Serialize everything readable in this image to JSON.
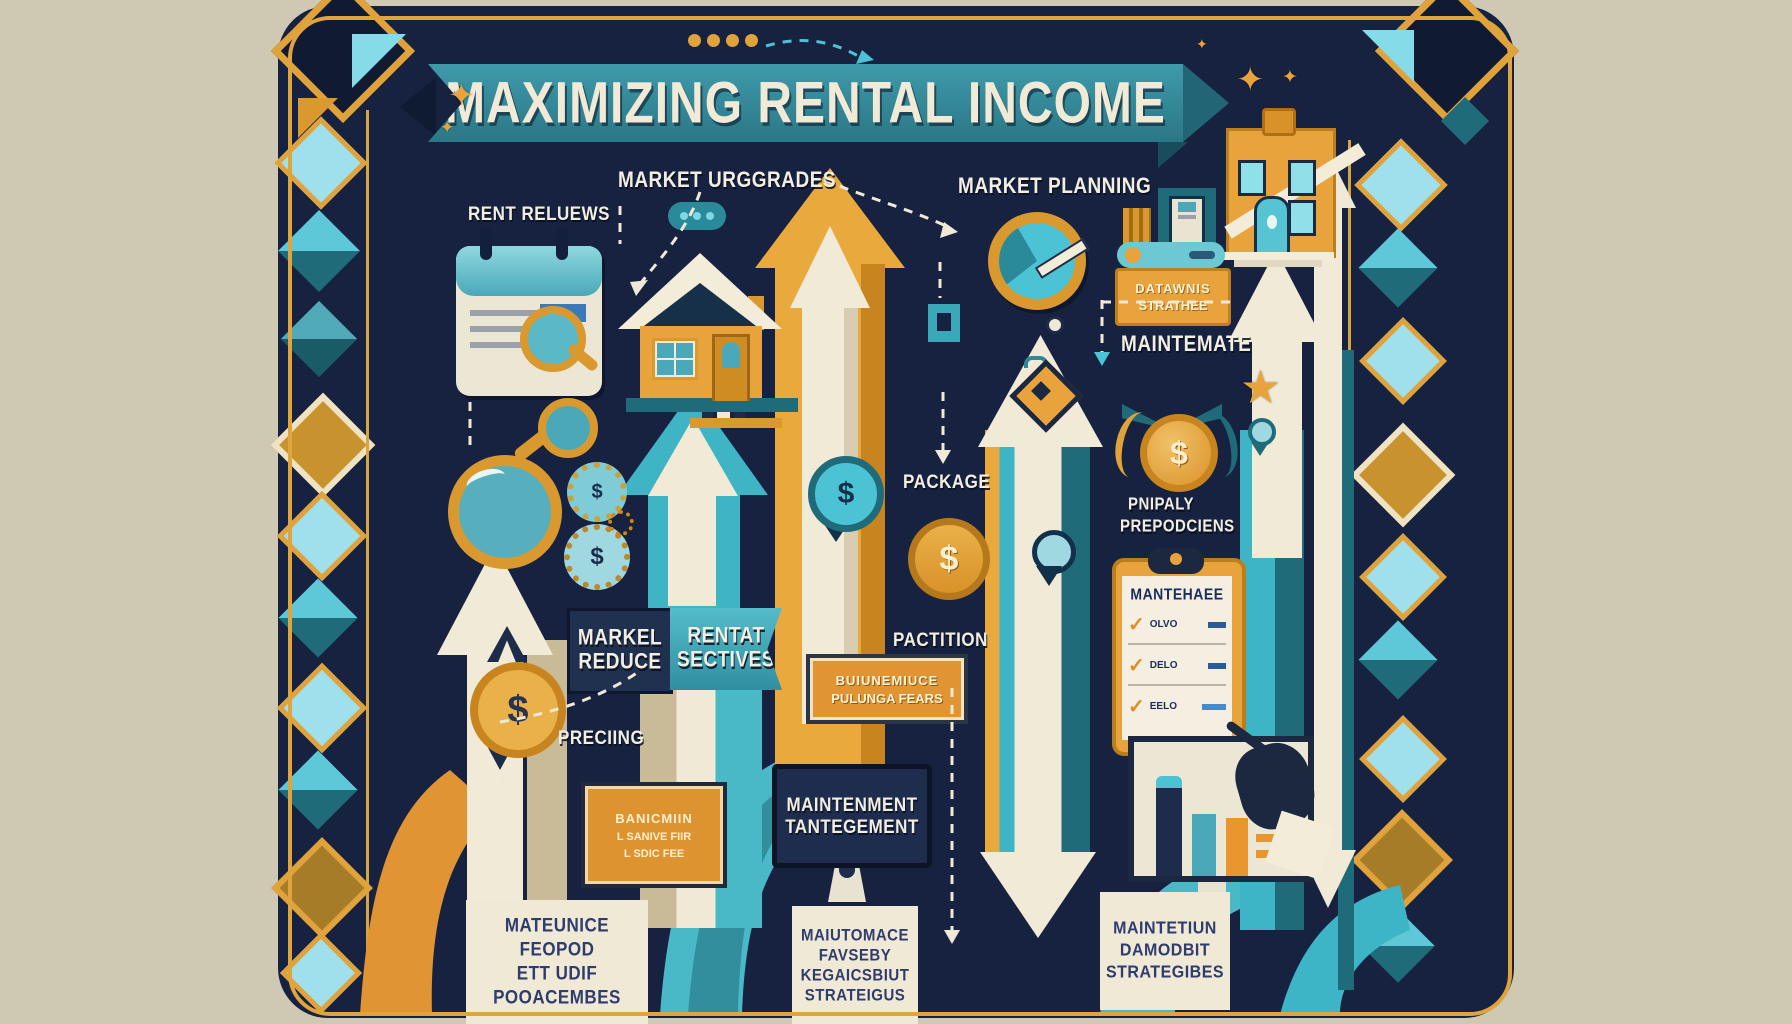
{
  "palette": {
    "background": "#cfc8b2",
    "panel_navy": "#172140",
    "teal": "#2f8fa0",
    "cyan": "#4cc3d4",
    "gold": "#e8a33d",
    "cream": "#f0ead6",
    "navy_box": "#1c2c4a"
  },
  "glyphs": {
    "sparkle": "✦",
    "star": "★",
    "dollar": "$",
    "check": "✓"
  },
  "title": {
    "banner": "MAXIMIZING RENTAL INCOME"
  },
  "labels": {
    "rent_reviews": "RENT RELUEWS",
    "market_upgrades": "MARKET URGGRADES",
    "market_planning": "MARKET PLANNING",
    "maintenate": "MAINTEMATE",
    "package": "PACKAGE",
    "pactition": "PACTITION",
    "pricing": "PRECIING",
    "properly_1": "PNIPALY",
    "properly_2": "PREPODCIENS"
  },
  "boxes": {
    "market_reduce": {
      "line1": "MARKEL",
      "line2": "REDUCE"
    },
    "rental_sectives": {
      "line1": "RENTAT",
      "line2": "SECTIVES"
    },
    "strategies_badge": {
      "line1": "DATAWNIS",
      "line2": "STRATHEE"
    },
    "package_fees": {
      "line1": "BUIUNEMIUCE",
      "line2": "PULUNGA FEARS"
    },
    "service_fee": {
      "line1": "BANICMIIN",
      "line2": "L SANIVE FIIR",
      "line3": "L SDIC FEE"
    },
    "maintenance_monitor": {
      "line1": "MAINTENMENT",
      "line2": "TANTEGEMENT"
    },
    "checklist": {
      "title": "MANTEHAEE",
      "items": [
        "OLVO",
        "DELO",
        "EELO"
      ]
    },
    "bottom_left": {
      "line1": "MATEUNICE",
      "line2": "FEOPOD",
      "line3": "ETT UDIF",
      "line4": "POOACEMBES"
    },
    "bottom_mid": {
      "line1": "MAIUTOMACE",
      "line2": "FAVSEBY",
      "line3": "KEGAICSBIUT",
      "line4": "STRATEIGUS"
    },
    "bottom_right": {
      "line1": "MAINTETIUN",
      "line2": "DAMODBIT",
      "line3": "STRATEGIBES"
    }
  }
}
